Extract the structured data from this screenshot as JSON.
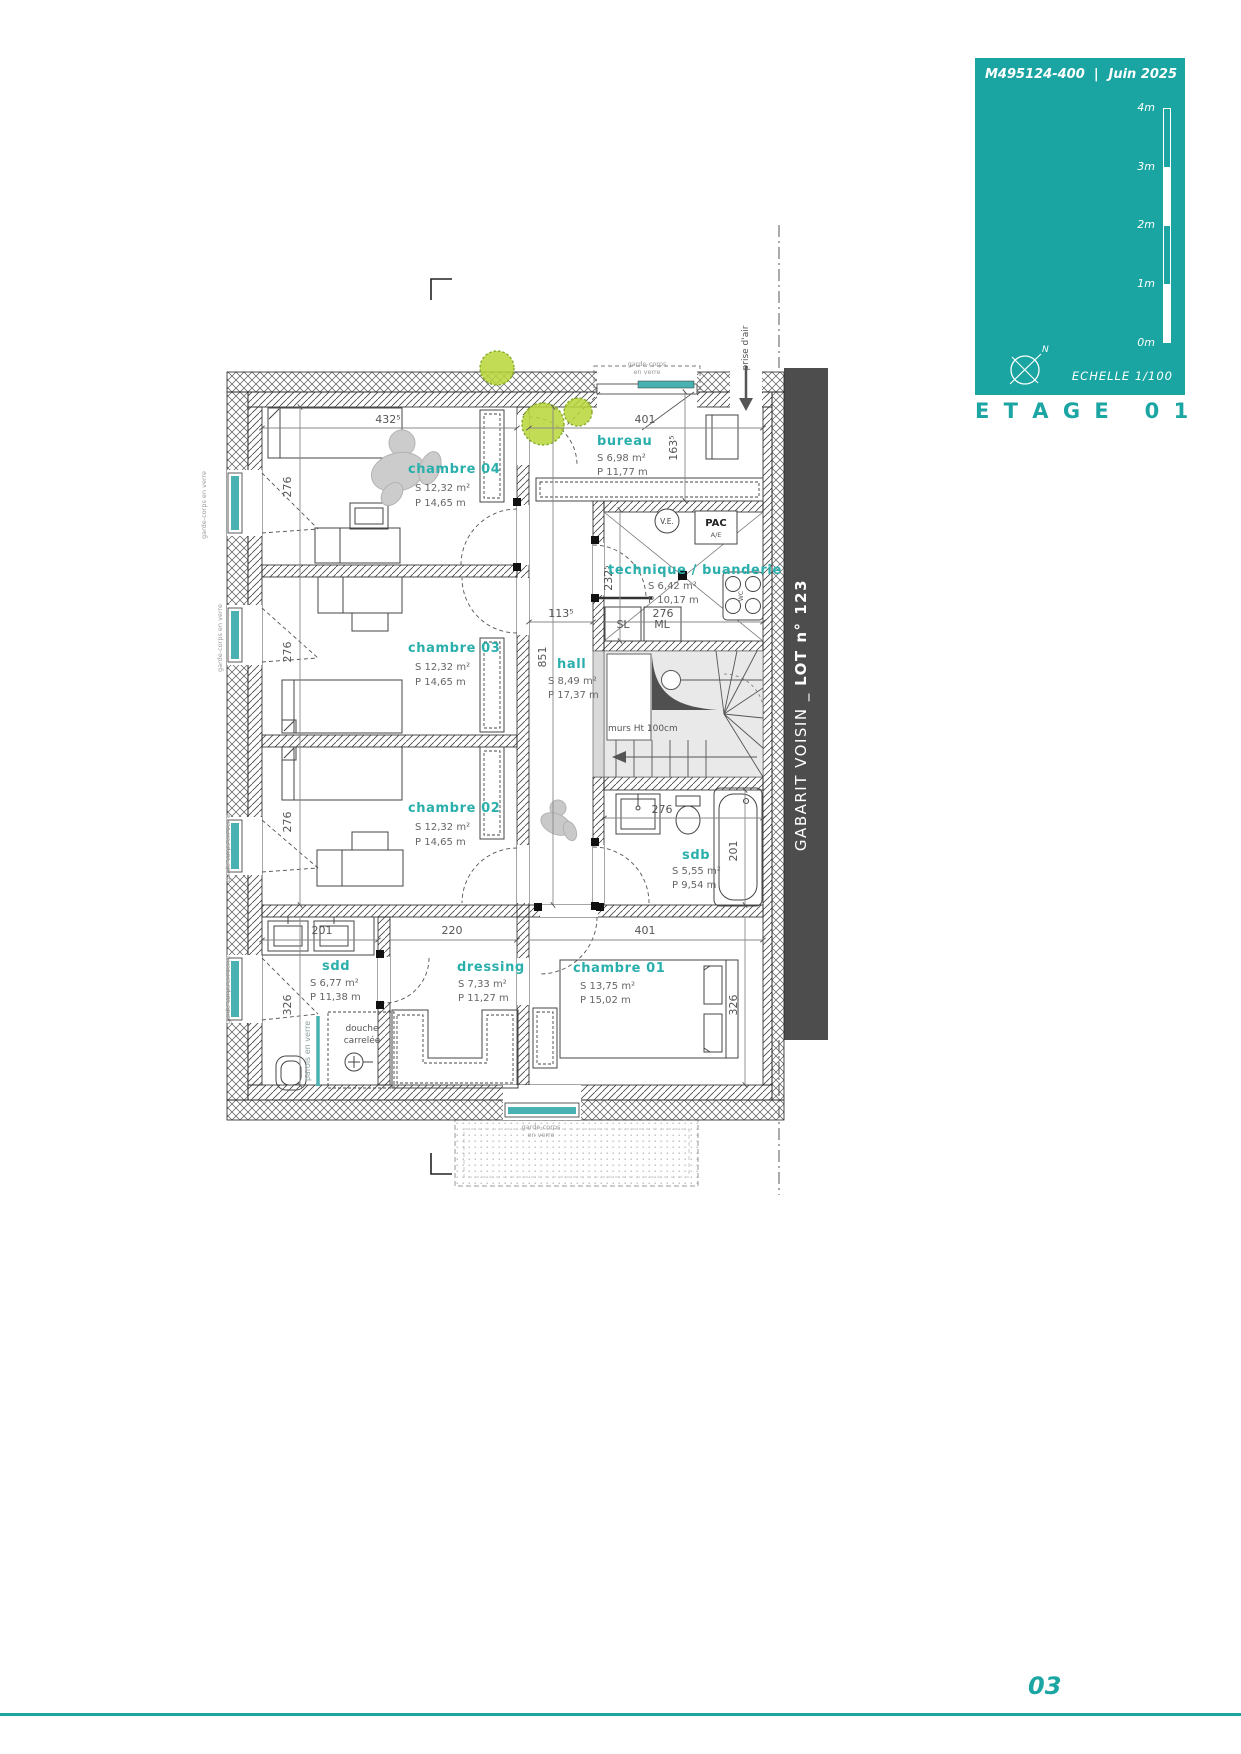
{
  "header": {
    "ref": "M495124-400",
    "pipe": "|",
    "date": "Juin 2025",
    "scale": [
      "4m",
      "3m",
      "2m",
      "1m",
      "0m"
    ],
    "echelle": "ECHELLE  1/100",
    "north": "N",
    "floor_title": "E T A G E   0 1"
  },
  "band": {
    "part1": "GABARIT VOISIN _ ",
    "part2": "LOT n° 123"
  },
  "rooms": {
    "ch04": {
      "name": "chambre 04",
      "s": "S  12,32 m²",
      "p": "P  14,65 m"
    },
    "ch03": {
      "name": "chambre 03",
      "s": "S  12,32 m²",
      "p": "P  14,65 m"
    },
    "ch02": {
      "name": "chambre 02",
      "s": "S  12,32 m²",
      "p": "P  14,65 m"
    },
    "ch01": {
      "name": "chambre 01",
      "s": "S  13,75 m²",
      "p": "P  15,02 m"
    },
    "bureau": {
      "name": "bureau",
      "s": "S  6,98 m²",
      "p": "P  11,77 m"
    },
    "tech": {
      "name": "technique / buanderie",
      "s": "S  6,42 m²",
      "p": "P  10,17 m"
    },
    "hall": {
      "name": "hall",
      "s": "S  8,49 m²",
      "p": "P  17,37 m"
    },
    "sdb": {
      "name": "sdb",
      "s": "S  5,55 m²",
      "p": "P  9,54 m"
    },
    "sdd": {
      "name": "sdd",
      "s": "S  6,77 m²",
      "p": "P  11,38 m"
    },
    "dressing": {
      "name": "dressing",
      "s": "S  7,33 m²",
      "p": "P  11,27 m"
    }
  },
  "dims": {
    "ch04_w": "432⁵",
    "ch04_h": "276",
    "ch03_h": "276",
    "ch02_h": "276",
    "sdd_h": "326",
    "bureau_w": "401",
    "bureau_h": "163⁵",
    "tech_h": "232⁵",
    "tech_w": "276",
    "hall_w": "113⁵",
    "hall_h": "851",
    "sdb_w": "276",
    "bath_h": "201",
    "sdd_w": "201",
    "dressing_w": "220",
    "ch01_w": "401",
    "ch01_h": "326"
  },
  "notes": {
    "garde_corps_a": "garde-corps",
    "garde_corps_b": "en verre",
    "garde_corps": "garde-corps en verre",
    "prise_air": "prise d'air",
    "murs": "murs Ht 100cm",
    "douche_a": "douche",
    "douche_b": "carrelée",
    "parois": "parois en verre",
    "ve": "V.E.",
    "pac": "PAC",
    "pac_sub": "A/E",
    "sl": "SL",
    "ml": "ML",
    "wc": "WC"
  },
  "footer": {
    "page": "03"
  },
  "colors": {
    "teal": "#1aa5a2",
    "label_teal": "#2aafac",
    "glazing": "#49b1b1",
    "band_gray": "#4d4d4d"
  }
}
